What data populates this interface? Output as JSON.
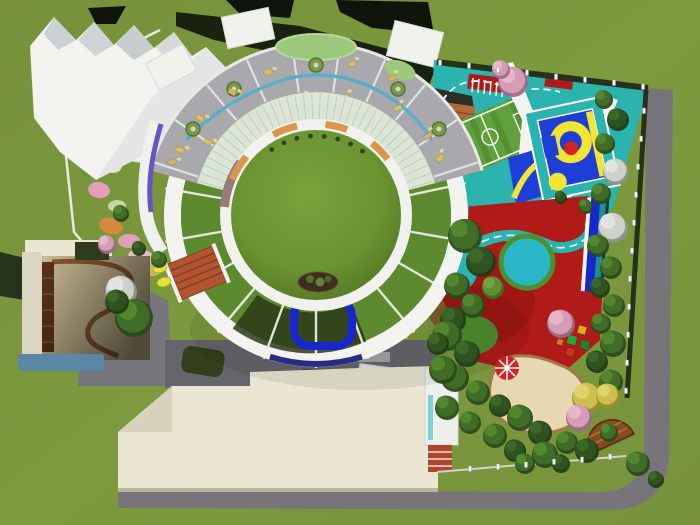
{
  "scene": {
    "name": "kindergarten-campus-aerial-render",
    "config": {
      "cx": 316,
      "cy": 215,
      "ring_line_angles": [
        348,
        10,
        30,
        50,
        70,
        90,
        110,
        130,
        150,
        170,
        190
      ],
      "glass_arc": {
        "a1": 192,
        "a2": 348,
        "step": 4,
        "r1": 96,
        "r2": 122
      },
      "partition_angles": [
        198,
        214,
        230,
        246,
        262,
        278,
        294,
        310,
        326,
        342
      ],
      "tuft_angles": [
        236,
        246,
        256,
        266,
        276,
        286,
        296,
        306
      ],
      "tuft_radius": 79
    },
    "palette": {
      "grass": "#7d9a3e",
      "grass_dark": "#5d7a2c",
      "lawn": "#6f9a34",
      "lawn_edge": "#4a6b20",
      "road": "#77757a",
      "court_gray": "#66656b",
      "side_gray": "#8b8a90",
      "white_roof": "#f3f3f0",
      "facet_gray": "#ccd2d4",
      "dark_roof": "#10150c",
      "dark_band": "#19220f",
      "hedge": "#24321a",
      "ring_green": "#5d8a2e",
      "ring_dark": "#2c3a16",
      "glass": "#dce6d6",
      "interior_floor": "#a9a8ad",
      "stream": "#58aecb",
      "pond": "#9cc87c",
      "bench_wood": "#d9974e",
      "brick_path": "#9b7a7e",
      "purple": "#6a53c5",
      "navy": "#262b85",
      "teal": "#2bb3af",
      "teal_pool": "#29b7c8",
      "soccer": "#60a13c",
      "court_blue": "#1d3fd6",
      "court_yellow": "#f2e433",
      "red_center": "#d62222",
      "red_ground": "#b01b18",
      "red_shade": "#8c1411",
      "sand": "#e7d8b2",
      "sand_border": "#a07b4b",
      "wood_deck": "#8a4a1f",
      "terracotta": "#b05530",
      "cream": "#eae6d1",
      "cream_shade": "#d6d2bc",
      "water": "#5b87a6",
      "pool_ring": "#1527cf",
      "tan_deck": "#e2cfa2",
      "duck": "#e8e13a",
      "asphalt": "#2c3024",
      "track_orange": "#b06a38"
    },
    "trees": [
      [
        603,
        98,
        9,
        "g"
      ],
      [
        617,
        118,
        11,
        "d"
      ],
      [
        604,
        142,
        10,
        "g"
      ],
      [
        615,
        170,
        13,
        "w"
      ],
      [
        600,
        192,
        10,
        "g"
      ],
      [
        612,
        226,
        15,
        "w"
      ],
      [
        597,
        244,
        11,
        "g"
      ],
      [
        610,
        266,
        11,
        "g"
      ],
      [
        599,
        286,
        10,
        "d"
      ],
      [
        613,
        304,
        11,
        "g"
      ],
      [
        600,
        322,
        10,
        "g"
      ],
      [
        612,
        342,
        13,
        "g"
      ],
      [
        596,
        360,
        11,
        "d"
      ],
      [
        610,
        380,
        12,
        "g"
      ],
      [
        586,
        396,
        15,
        "y"
      ],
      [
        607,
        394,
        12,
        "y"
      ],
      [
        578,
        416,
        13,
        "p"
      ],
      [
        560,
        322,
        14,
        "p"
      ],
      [
        512,
        80,
        15,
        "p"
      ],
      [
        500,
        68,
        9,
        "p"
      ],
      [
        464,
        234,
        17,
        "g"
      ],
      [
        480,
        260,
        15,
        "d"
      ],
      [
        456,
        284,
        13,
        "g"
      ],
      [
        472,
        304,
        12,
        "g"
      ],
      [
        492,
        286,
        11,
        "l"
      ],
      [
        452,
        318,
        13,
        "d"
      ],
      [
        446,
        334,
        15,
        "g"
      ],
      [
        466,
        352,
        13,
        "d"
      ],
      [
        454,
        376,
        14,
        "g"
      ],
      [
        477,
        391,
        12,
        "g"
      ],
      [
        499,
        404,
        11,
        "d"
      ],
      [
        446,
        406,
        12,
        "g"
      ],
      [
        519,
        416,
        13,
        "g"
      ],
      [
        539,
        431,
        12,
        "d"
      ],
      [
        469,
        421,
        11,
        "g"
      ],
      [
        494,
        434,
        12,
        "g"
      ],
      [
        514,
        449,
        11,
        "d"
      ],
      [
        544,
        453,
        13,
        "g"
      ],
      [
        566,
        441,
        11,
        "g"
      ],
      [
        586,
        449,
        12,
        "d"
      ],
      [
        608,
        431,
        9,
        "g"
      ],
      [
        637,
        462,
        12,
        "g"
      ],
      [
        655,
        478,
        8,
        "d"
      ],
      [
        524,
        462,
        10,
        "g"
      ],
      [
        560,
        462,
        9,
        "d"
      ],
      [
        120,
        212,
        8,
        "g"
      ],
      [
        138,
        247,
        7,
        "d"
      ],
      [
        158,
        258,
        8,
        "g"
      ],
      [
        120,
        290,
        16,
        "w"
      ],
      [
        133,
        316,
        19,
        "g"
      ],
      [
        116,
        300,
        12,
        "d"
      ],
      [
        106,
        243,
        9,
        "p"
      ],
      [
        442,
        368,
        14,
        "g"
      ],
      [
        437,
        342,
        11,
        "d"
      ],
      [
        585,
        205,
        7,
        "g"
      ],
      [
        560,
        196,
        6,
        "d"
      ]
    ],
    "fence_posts": [
      [
        440,
        64
      ],
      [
        469,
        67
      ],
      [
        498,
        71
      ],
      [
        527,
        74
      ],
      [
        556,
        78
      ],
      [
        585,
        81
      ],
      [
        614,
        84
      ],
      [
        643,
        88
      ],
      [
        644,
        112
      ],
      [
        641,
        140
      ],
      [
        638,
        168
      ],
      [
        636,
        196
      ],
      [
        634,
        224
      ],
      [
        632,
        252
      ],
      [
        630,
        280
      ],
      [
        629,
        308
      ],
      [
        628,
        336
      ],
      [
        627,
        364
      ],
      [
        626,
        392
      ],
      [
        470,
        470
      ],
      [
        498,
        468
      ],
      [
        526,
        466
      ],
      [
        554,
        463
      ],
      [
        582,
        461
      ],
      [
        610,
        458
      ]
    ],
    "benches": [
      {
        "a1": 203,
        "a2": 220
      },
      {
        "a1": 242,
        "a2": 258
      },
      {
        "a1": 276,
        "a2": 290
      },
      {
        "a1": 308,
        "a2": 322
      }
    ],
    "stream_beads": [
      [
        193,
        129
      ],
      [
        234,
        89
      ],
      [
        316,
        65
      ],
      [
        398,
        89
      ],
      [
        439,
        129
      ]
    ],
    "furniture": [
      [
        180,
        150,
        20,
        "y"
      ],
      [
        200,
        118,
        25,
        "y"
      ],
      [
        232,
        92,
        30,
        "t"
      ],
      [
        268,
        72,
        10,
        "y"
      ],
      [
        352,
        64,
        -10,
        "y"
      ],
      [
        392,
        78,
        -20,
        "t"
      ],
      [
        300,
        97,
        0,
        "y"
      ],
      [
        254,
        112,
        20,
        "t"
      ],
      [
        208,
        142,
        25,
        "y"
      ],
      [
        345,
        97,
        -15,
        "y"
      ],
      [
        398,
        108,
        -25,
        "y"
      ],
      [
        428,
        136,
        -35,
        "t"
      ],
      [
        440,
        158,
        -40,
        "y"
      ],
      [
        172,
        162,
        15,
        "t"
      ]
    ],
    "flowers": [
      [
        96,
        150,
        17,
        11,
        15,
        "tan"
      ],
      [
        113,
        166,
        9,
        7,
        0,
        "white"
      ],
      [
        99,
        190,
        11,
        8,
        10,
        "pink"
      ],
      [
        117,
        206,
        9,
        6,
        0,
        "palegreen"
      ],
      [
        111,
        226,
        12,
        8,
        15,
        "orange"
      ],
      [
        129,
        241,
        11,
        7,
        0,
        "pink"
      ],
      [
        141,
        257,
        13,
        8,
        10,
        "pinklight"
      ],
      [
        88,
        172,
        7,
        5,
        0,
        "green"
      ],
      [
        152,
        270,
        9,
        6,
        0,
        "tan"
      ]
    ],
    "blocks": [
      [
        563,
        330,
        8,
        "#2244cc"
      ],
      [
        572,
        340,
        9,
        "#22aa33"
      ],
      [
        582,
        330,
        8,
        "#ddaa22"
      ],
      [
        570,
        352,
        8,
        "#cc3322"
      ],
      [
        585,
        345,
        9,
        "#2a7d2a"
      ],
      [
        592,
        355,
        7,
        "#d0d02a"
      ],
      [
        560,
        342,
        6,
        "#d07a2a"
      ]
    ],
    "ducks": [
      [
        160,
        268
      ],
      [
        164,
        282
      ]
    ]
  }
}
